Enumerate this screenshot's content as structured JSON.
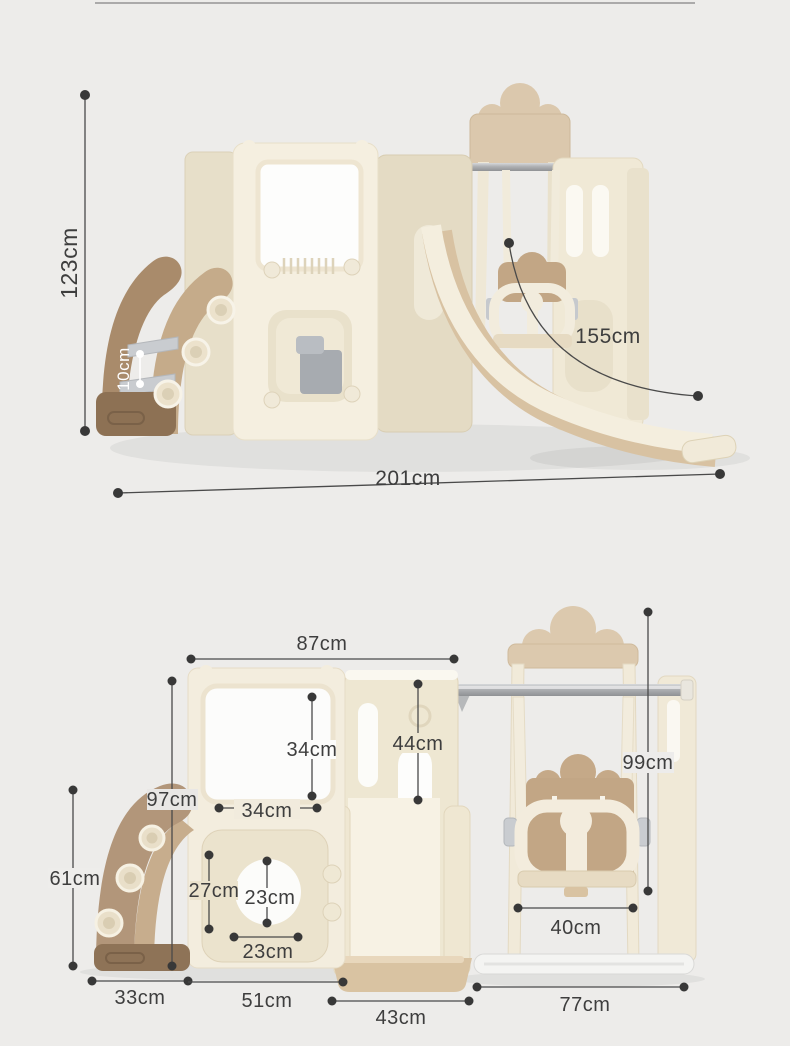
{
  "page": {
    "background": "#edecea",
    "divider_color": "#9a9a9a"
  },
  "palette": {
    "cream": "#f4eede",
    "cream_shadow": "#e5dcc5",
    "beige_slide": "#d8c2a2",
    "tan_seat": "#c2a685",
    "brown_ladder": "#a98b6b",
    "brown_dark_base": "#8d7154",
    "step_gray": "#c6c9cd",
    "metal_gray": "#b0b2b5",
    "window_white": "#fdfdfd",
    "annotation_dark": "#3e3e3e",
    "annotation_white": "#ffffff"
  },
  "views": {
    "perspective": {
      "dimensions": {
        "total_height": "123cm",
        "step_height": "10cm",
        "slide_length": "155cm",
        "total_length": "201cm"
      }
    },
    "front": {
      "dimensions": {
        "tower_width": "87cm",
        "tower_height": "97cm",
        "window_height": "34cm",
        "window_width": "34cm",
        "mid_panel_height": "44cm",
        "swing_height": "99cm",
        "porthole_panel_height": "27cm",
        "porthole_height": "23cm",
        "porthole_width": "23cm",
        "ladder_height": "61cm",
        "ladder_width": "33cm",
        "base_width": "51cm",
        "slide_width": "43cm",
        "seat_width": "40cm",
        "swing_base_width": "77cm"
      }
    }
  }
}
